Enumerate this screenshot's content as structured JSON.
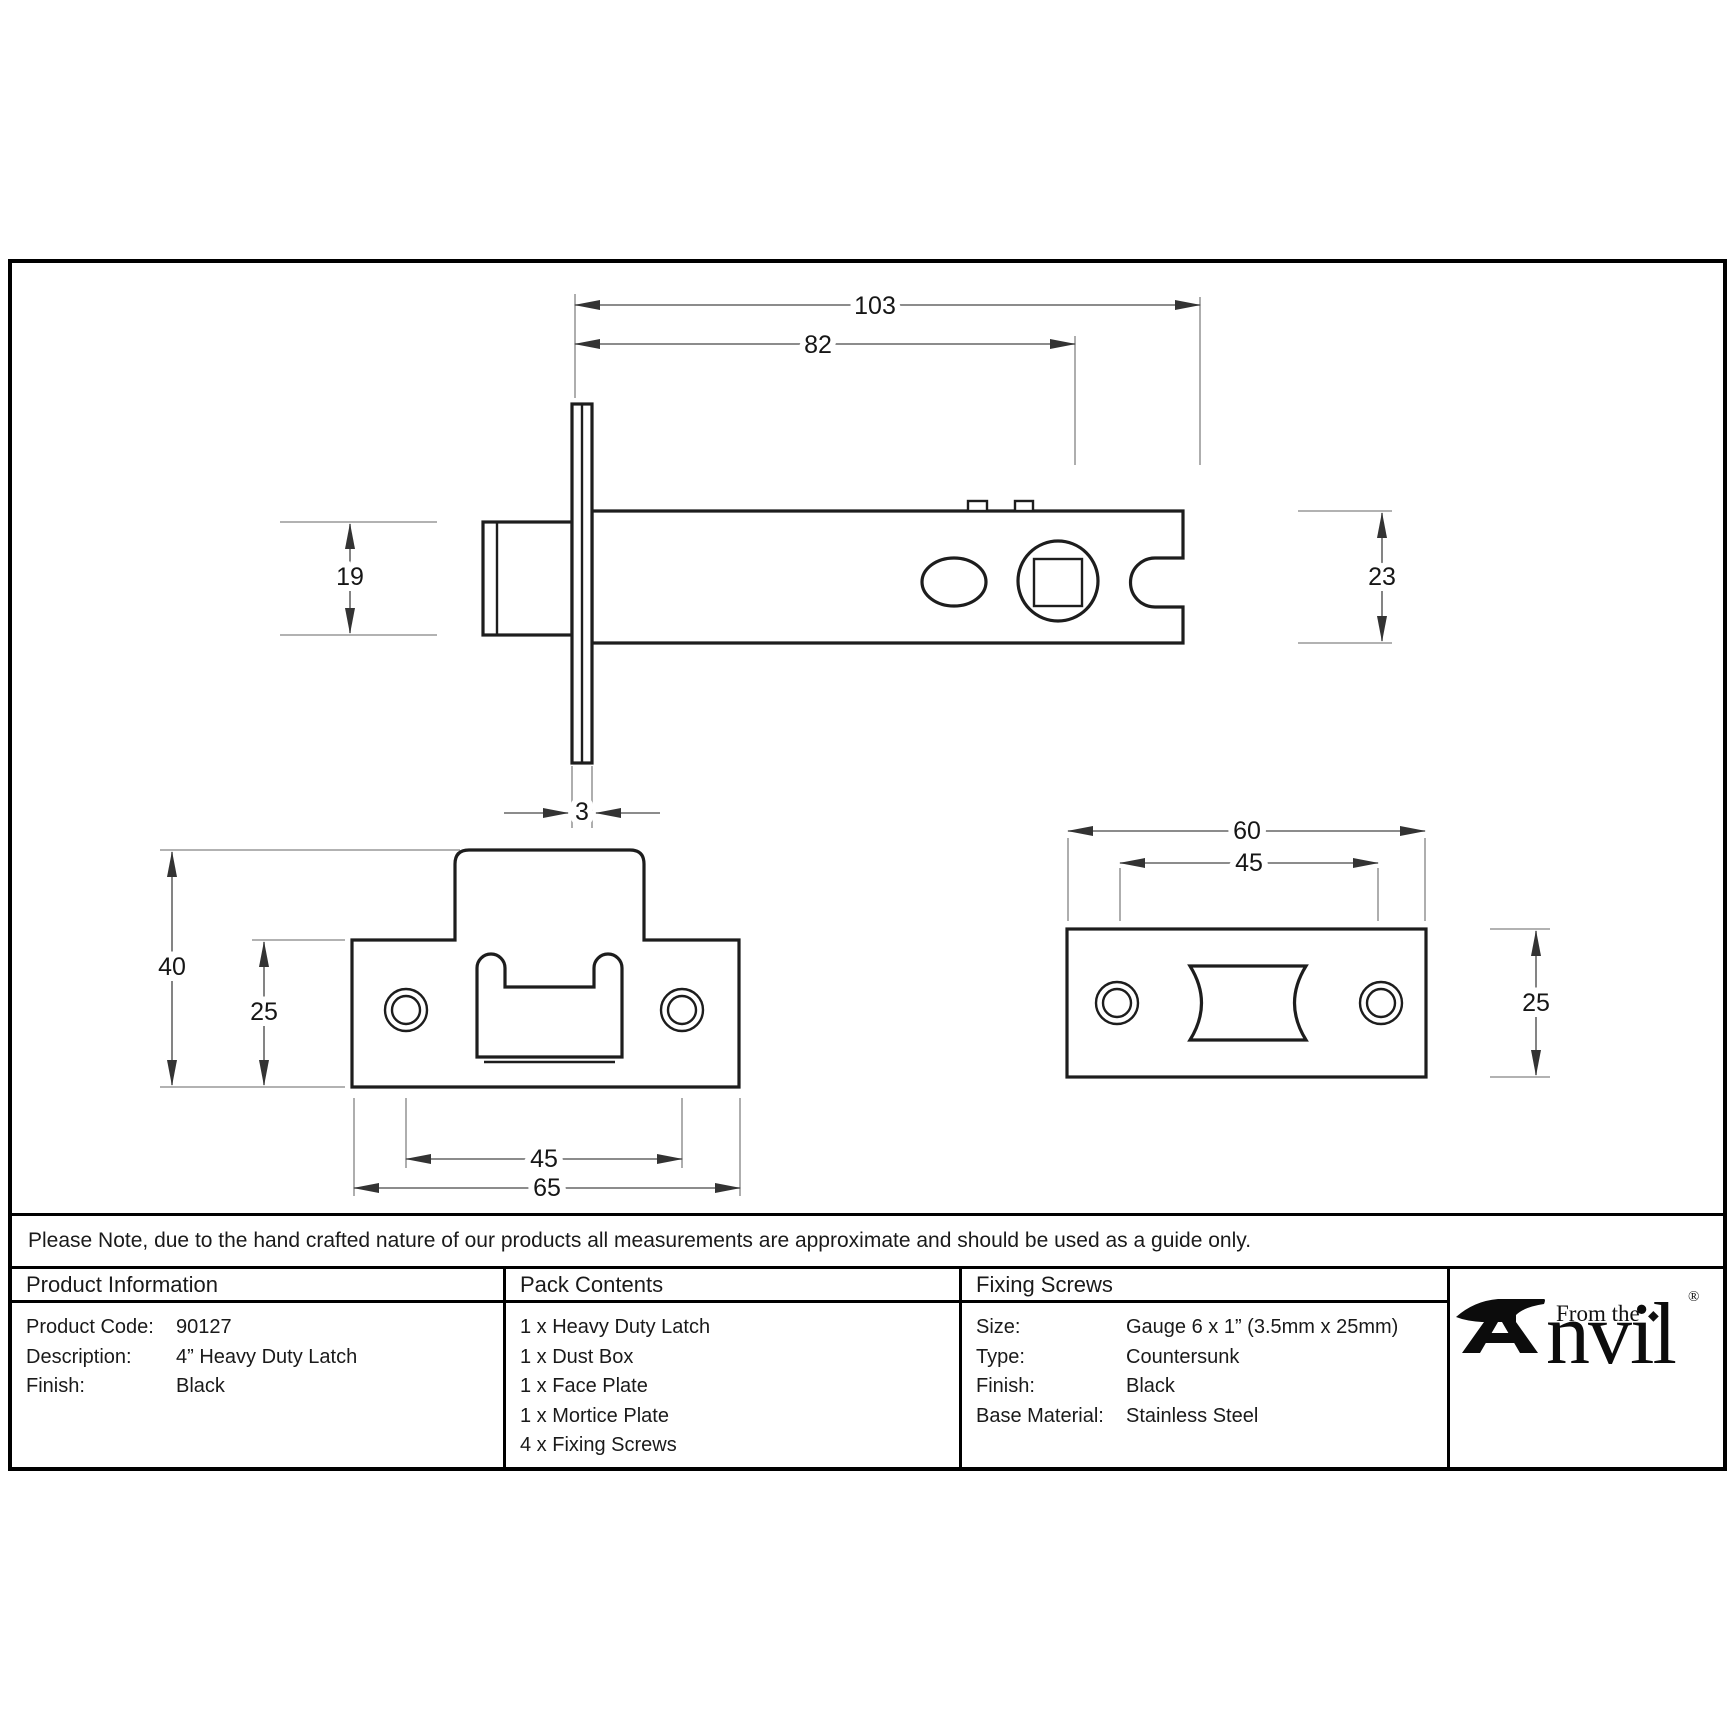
{
  "note": "Please Note, due to the hand crafted nature of our products all measurements are approximate and should be used as a guide only.",
  "drawing": {
    "side_view": {
      "dims": {
        "total_length": "103",
        "case_length": "82",
        "bolt_height": "19",
        "case_height": "23",
        "plate_thickness": "3"
      }
    },
    "face_plate_view": {
      "dims": {
        "overall_height": "40",
        "plate_height": "25",
        "screw_spacing": "45",
        "width": "65"
      }
    },
    "mortice_plate_view": {
      "dims": {
        "width": "60",
        "screw_spacing": "45",
        "height": "25"
      }
    }
  },
  "table": {
    "product_information": {
      "header": "Product Information",
      "rows": [
        {
          "label": "Product Code:",
          "value": "90127"
        },
        {
          "label": "Description:",
          "value": "4” Heavy Duty Latch"
        },
        {
          "label": "Finish:",
          "value": "Black"
        }
      ]
    },
    "pack_contents": {
      "header": "Pack Contents",
      "items": [
        "1 x Heavy Duty Latch",
        "1 x Dust Box",
        "1 x Face Plate",
        "1 x Mortice Plate",
        "4 x Fixing Screws"
      ]
    },
    "fixing_screws": {
      "header": "Fixing Screws",
      "rows": [
        {
          "label": "Size:",
          "value": "Gauge 6 x 1” (3.5mm x 25mm)"
        },
        {
          "label": "Type:",
          "value": "Countersunk"
        },
        {
          "label": "Finish:",
          "value": "Black"
        },
        {
          "label": "Base Material:",
          "value": "Stainless Steel"
        }
      ]
    },
    "logo": {
      "prefix": "From the",
      "name": "nvil",
      "diamond": "◆",
      "registered": "®"
    }
  },
  "colors": {
    "ink": "#1d1d1d",
    "dimension_lines": "#666666",
    "witness_lines": "#999999",
    "background": "#ffffff"
  }
}
